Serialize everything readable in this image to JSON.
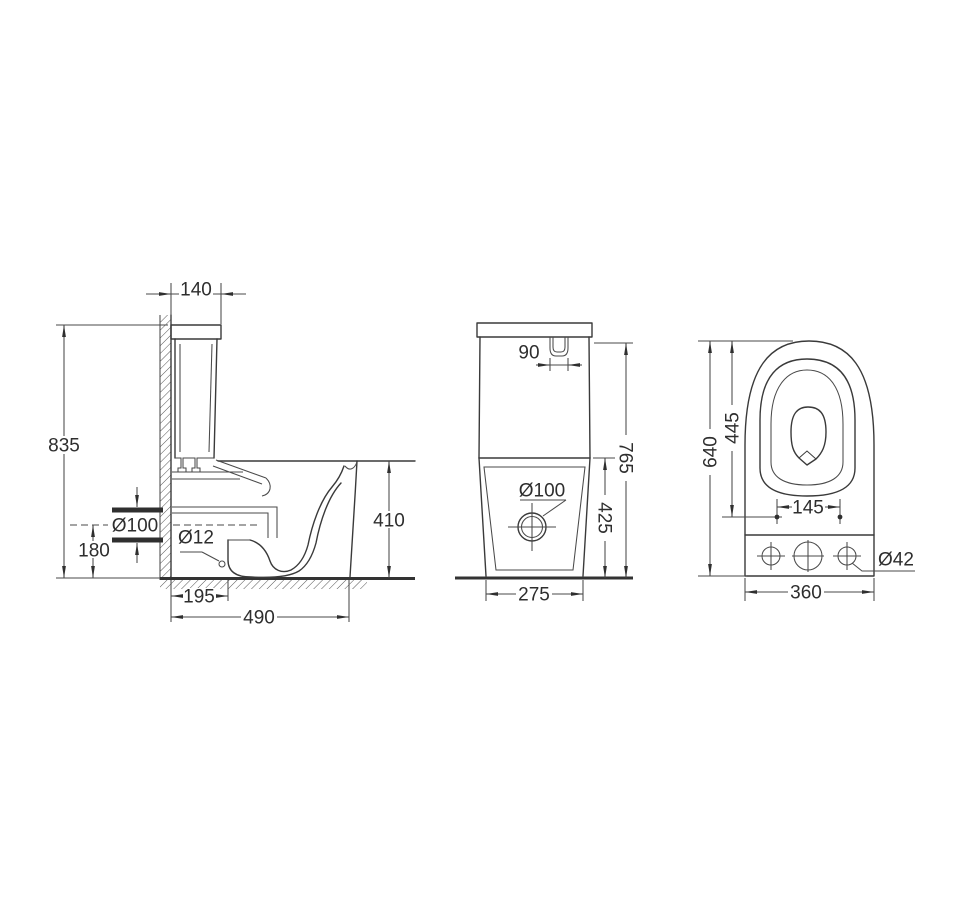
{
  "drawing": {
    "type": "technical-dimension-drawing",
    "subject": "two-piece toilet (side section, front view, rear/top view)",
    "colors": {
      "line": "#3a3a3a",
      "background": "#ffffff"
    },
    "side_view": {
      "labels": {
        "tank_top_depth": "140",
        "total_height": "835",
        "outlet_pipe_diameter": "Ø100",
        "outlet_center_height": "180",
        "fixing_hole_diameter": "Ø12",
        "outlet_setback": "195",
        "overall_depth": "490",
        "bowl_rim_height": "410"
      }
    },
    "front_view": {
      "labels": {
        "flush_button_width": "90",
        "overall_height": "765",
        "bowl_section_height": "425",
        "drain_diameter": "Ø100",
        "base_width": "275"
      }
    },
    "top_view": {
      "labels": {
        "overall_length": "640",
        "seat_opening_length": "445",
        "fixing_hole_spacing": "145",
        "side_hole_diameter": "Ø42",
        "overall_width": "360"
      }
    }
  }
}
